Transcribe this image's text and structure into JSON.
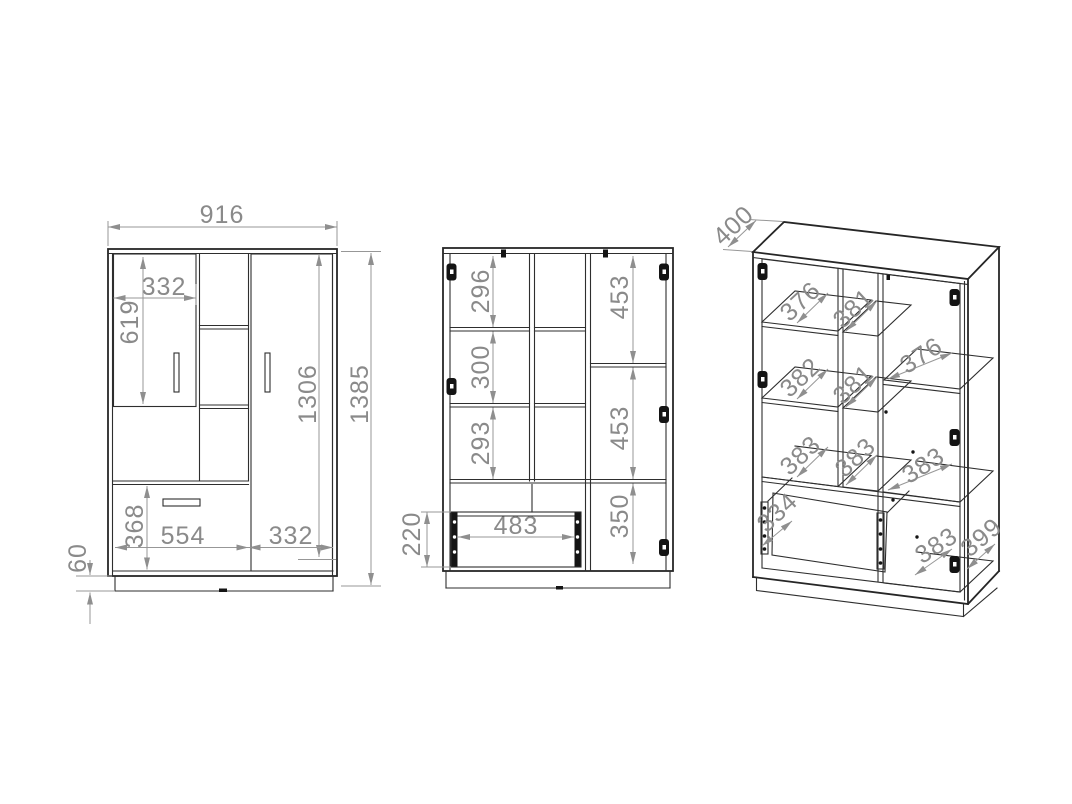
{
  "canvas": {
    "background": "#ffffff",
    "drawing_color": "#262626",
    "dimension_color": "#8a8a8a"
  },
  "views": {
    "front": {
      "label": "front-exterior-view",
      "dimensions": {
        "total_width": "916",
        "left_door_width": "332",
        "left_door_height": "619",
        "carcass_inner_height": "1306",
        "total_height": "1385",
        "drawer_front_height": "368",
        "drawer_section_width": "554",
        "right_door_width": "332",
        "plinth_height": "60"
      }
    },
    "interior": {
      "label": "front-interior-view",
      "dimensions": {
        "top_compartment_height": "296",
        "middle_compartment_height": "300",
        "lower_compartment_height": "293",
        "right_upper_height": "453",
        "right_middle_height": "453",
        "right_lower_height": "350",
        "drawer_inner_width": "483",
        "drawer_box_height": "220"
      }
    },
    "perspective": {
      "label": "perspective-interior-view",
      "dimensions": {
        "top_panel_depth": "400",
        "left_shelf_1_depth": "376",
        "left_shelf_2_depth": "382",
        "left_shelf_3_depth": "383",
        "drawer_depth": "334",
        "mid_shelf_1_depth": "381",
        "mid_shelf_2_depth": "381",
        "mid_shelf_3_depth": "383",
        "right_shelf_1_depth": "376",
        "right_shelf_2_depth": "383",
        "right_bottom_depth": "383",
        "side_panel_depth": "399"
      }
    }
  }
}
